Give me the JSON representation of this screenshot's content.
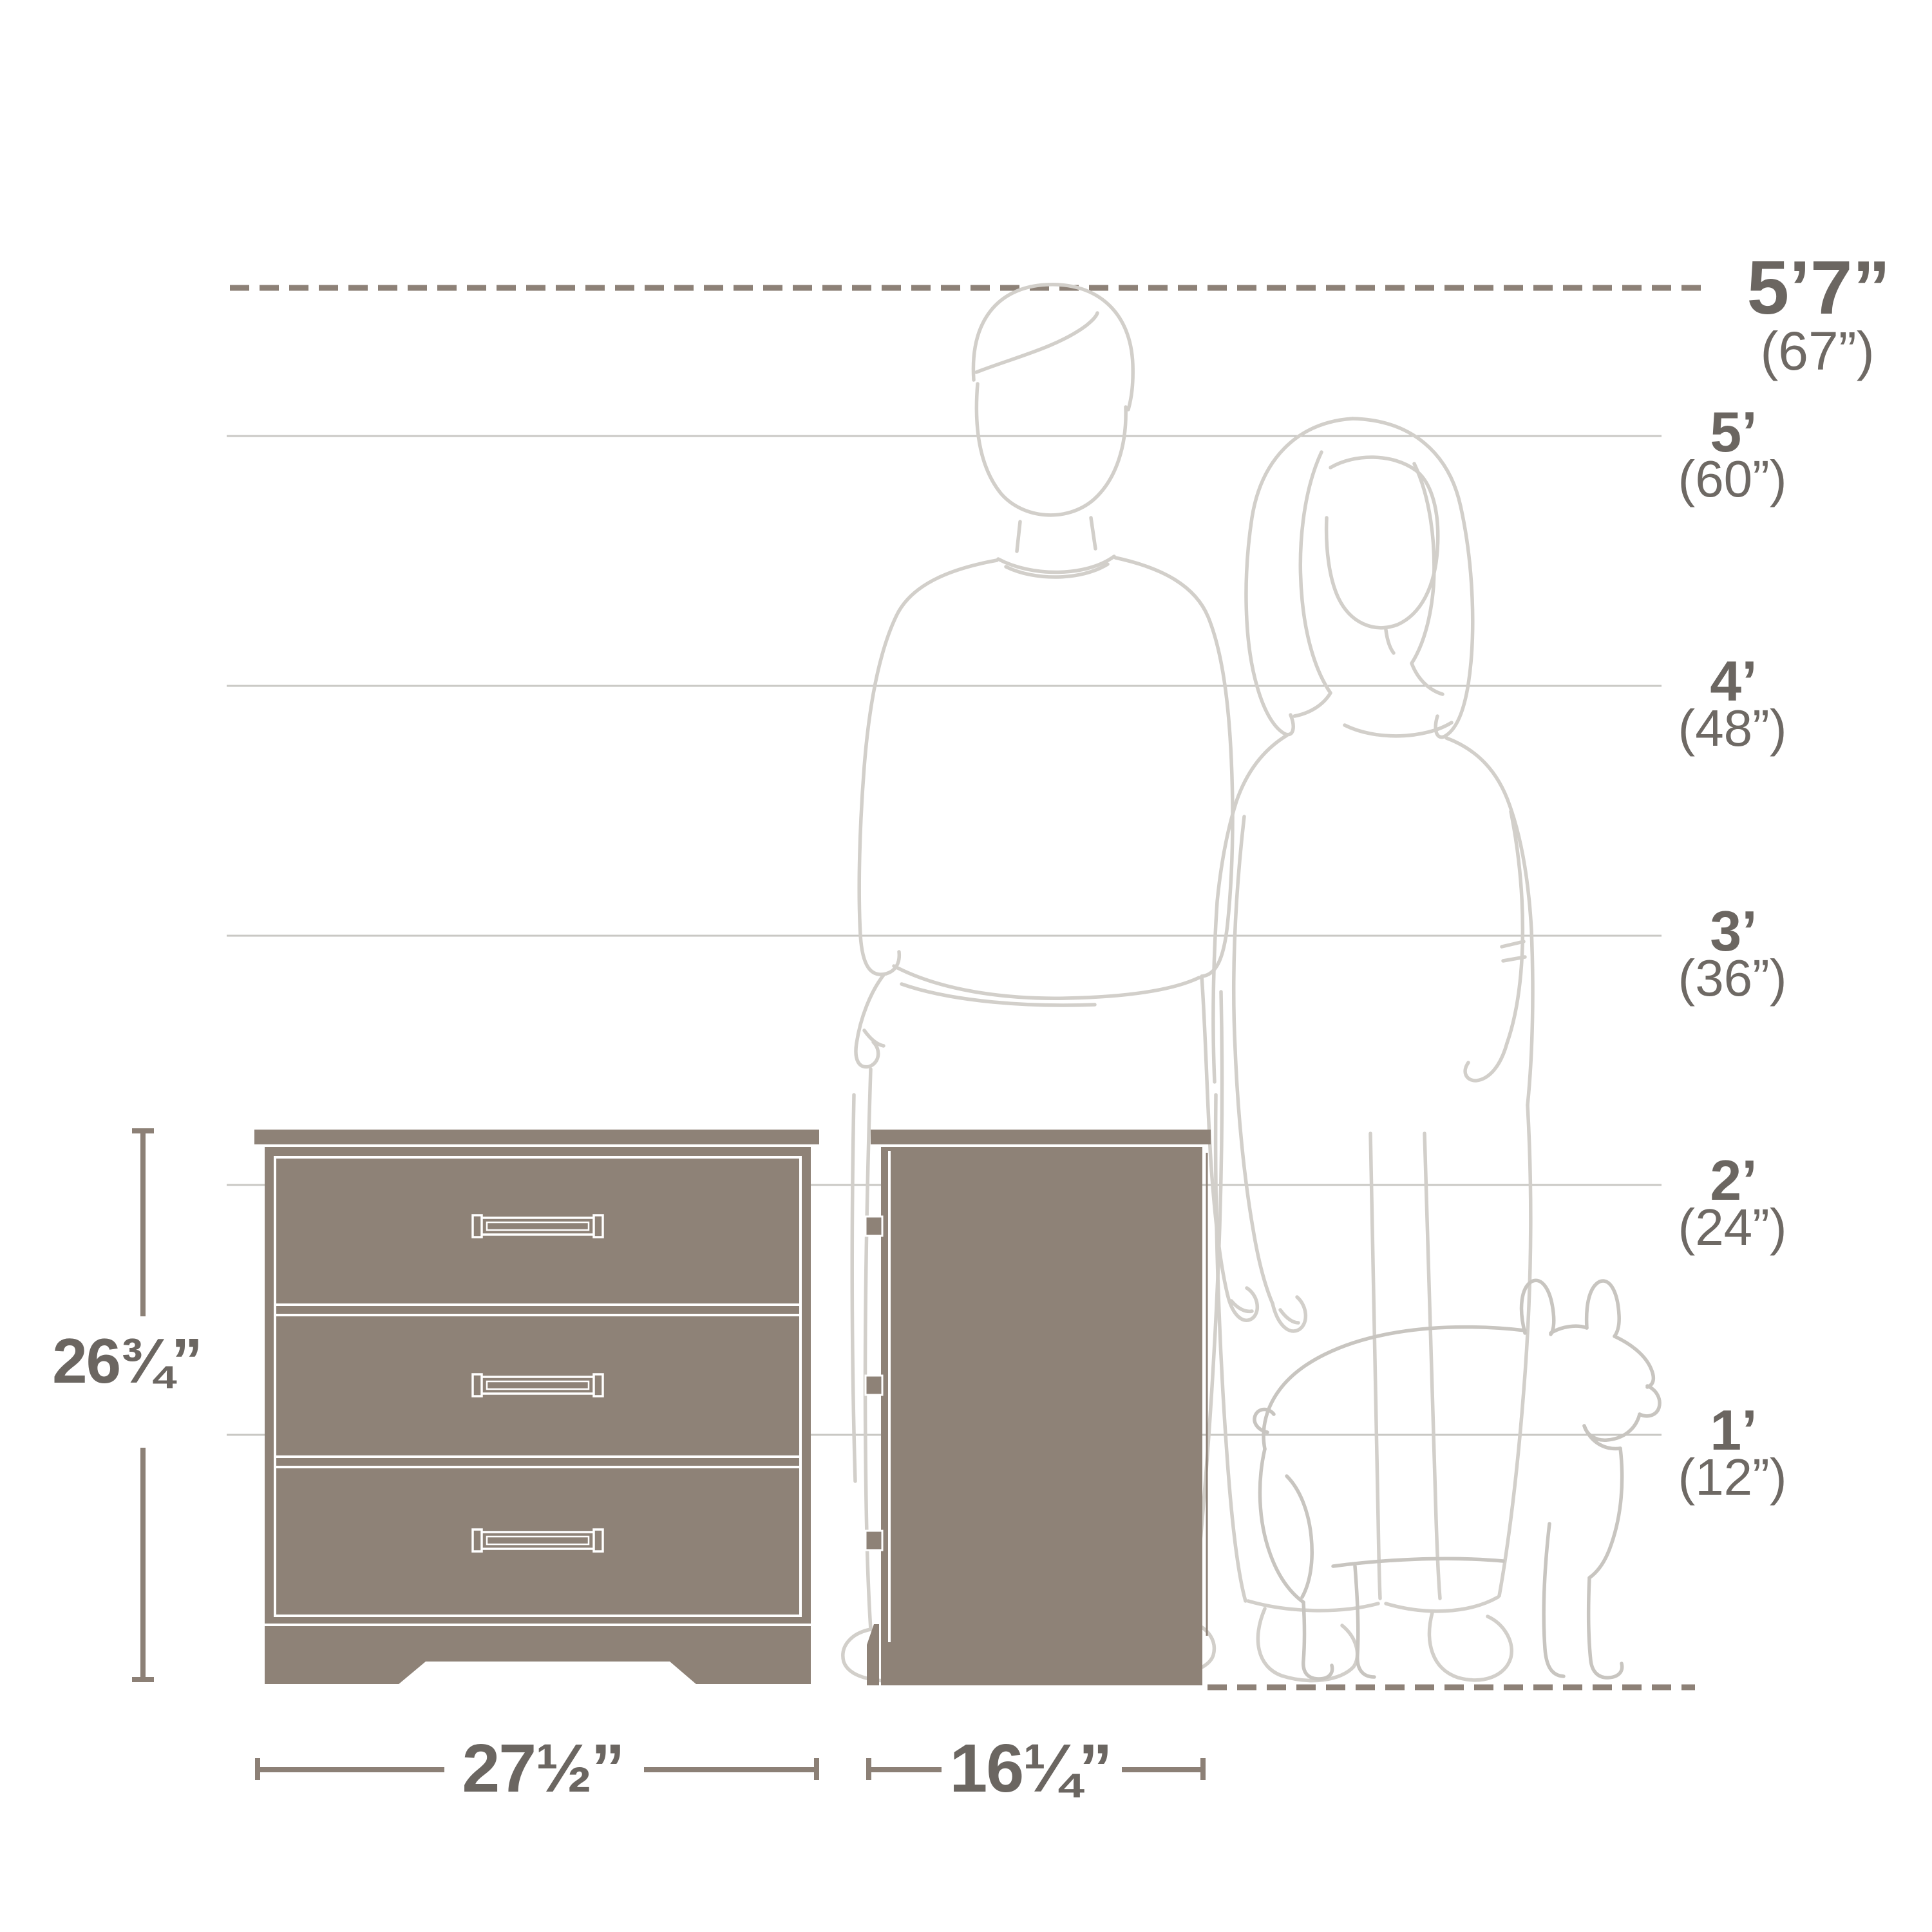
{
  "ruler": {
    "top": {
      "feet": "5’7”",
      "inches": "(67”)",
      "height_in": 67
    },
    "marks": [
      {
        "feet": "5’",
        "inches": "(60”)",
        "height_in": 60
      },
      {
        "feet": "4’",
        "inches": "(48”)",
        "height_in": 48
      },
      {
        "feet": "3’",
        "inches": "(36”)",
        "height_in": 36
      },
      {
        "feet": "2’",
        "inches": "(24”)",
        "height_in": 24
      },
      {
        "feet": "1’",
        "inches": "(12”)",
        "height_in": 12
      }
    ]
  },
  "dimensions": {
    "height": {
      "label": "26¾”",
      "inches": 26.75
    },
    "width": {
      "label": "27½”",
      "inches": 27.5
    },
    "depth": {
      "label": "16¼”",
      "inches": 16.25
    }
  },
  "product": {
    "views": [
      "front",
      "side"
    ],
    "drawer_count": 3
  },
  "scene": {
    "people_count": 2,
    "dog_count": 1
  },
  "colors": {
    "furniture_fill": "#8e8277",
    "dimension_line": "#8c8076",
    "grid_line": "#c9c8c4",
    "figure_line": "#d2cfca",
    "dog_line": "#c8c5c0",
    "label_text": "#6b6661",
    "background": "#ffffff"
  }
}
